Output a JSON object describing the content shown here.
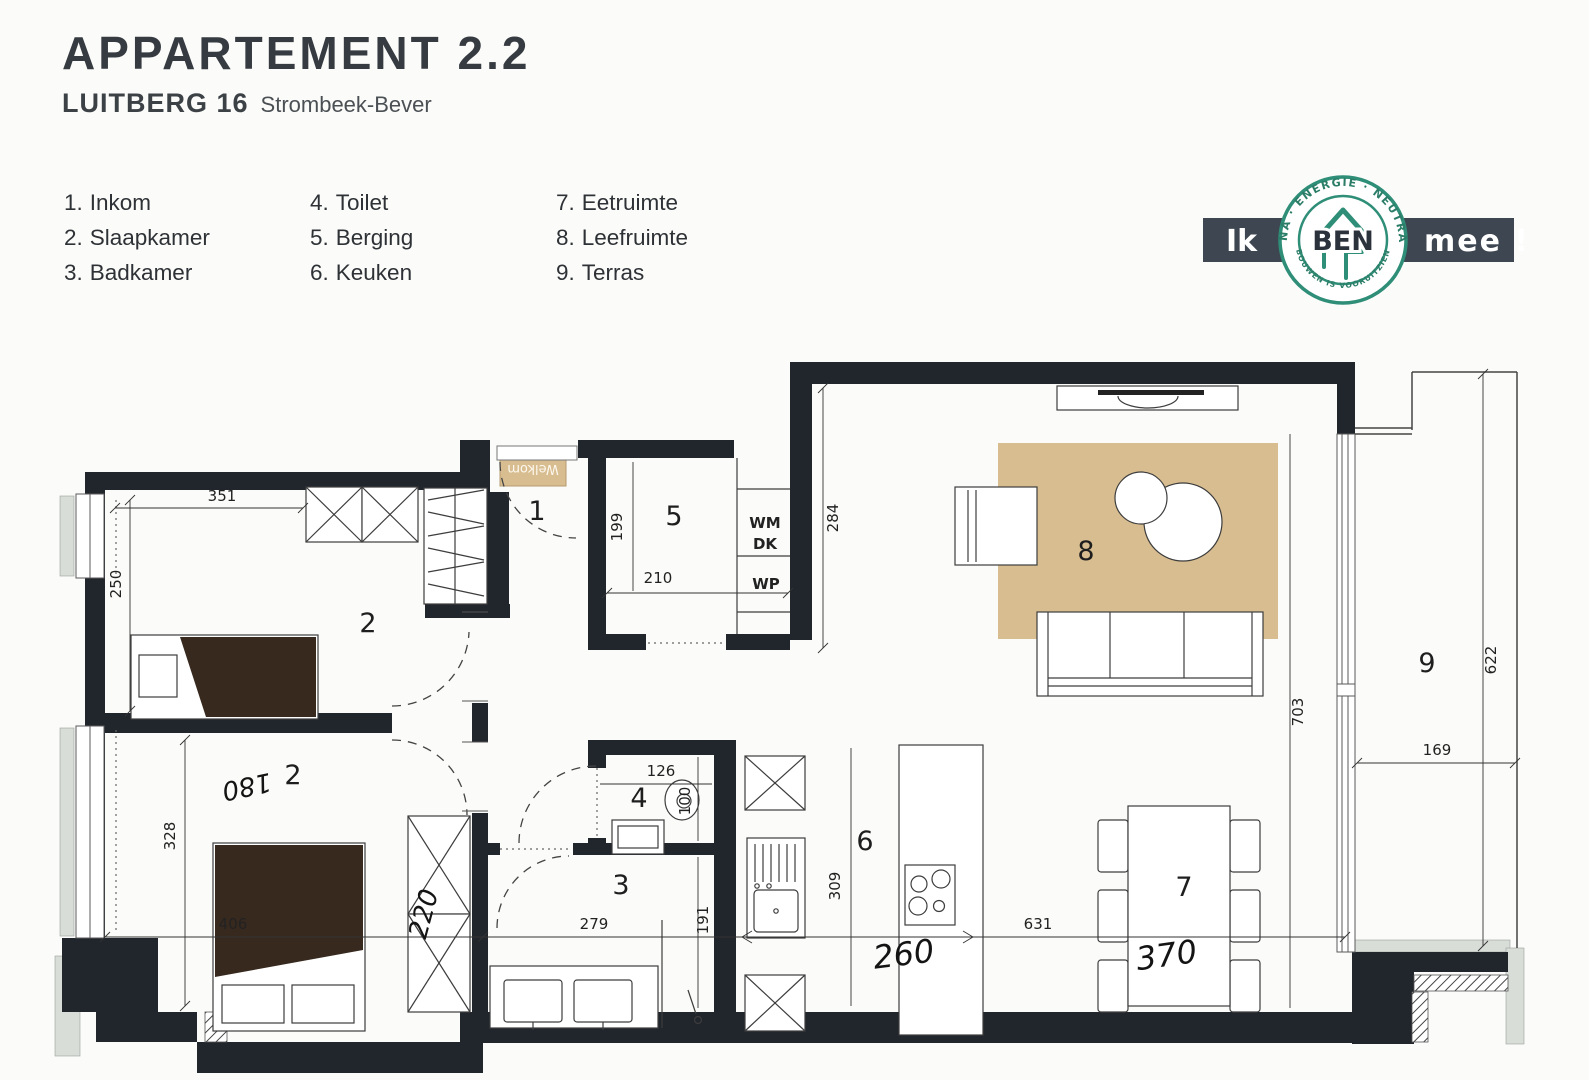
{
  "header": {
    "title": "APPARTEMENT 2.2",
    "project": "LUITBERG 16",
    "city": "Strombeek-Bever"
  },
  "legend": {
    "items": [
      {
        "num": "1.",
        "label": "Inkom"
      },
      {
        "num": "2.",
        "label": "Slaapkamer"
      },
      {
        "num": "3.",
        "label": "Badkamer"
      },
      {
        "num": "4.",
        "label": "Toilet"
      },
      {
        "num": "5.",
        "label": "Berging"
      },
      {
        "num": "6.",
        "label": "Keuken"
      },
      {
        "num": "7.",
        "label": "Eetruimte"
      },
      {
        "num": "8.",
        "label": "Leefruimte"
      },
      {
        "num": "9.",
        "label": "Terras"
      }
    ]
  },
  "logo": {
    "left": "Ik",
    "center": "BEN",
    "right": "mee !",
    "ring_top": "BIJNA · ENERGIE · NEUTRAAL",
    "ring_bottom": "BOUWEN IS VOORUITZIEN",
    "banner_color": "#3e4651",
    "ring_color": "#2f8e77"
  },
  "plan": {
    "rooms": {
      "r1": "1",
      "r2a": "2",
      "r2b": "2",
      "r3": "3",
      "r4": "4",
      "r5": "5",
      "r6": "6",
      "r7": "7",
      "r8": "8",
      "r9": "9"
    },
    "dims": {
      "d351": "351",
      "d250": "250",
      "d199": "199",
      "d210": "210",
      "d284": "284",
      "d703": "703",
      "d622": "622",
      "d169": "169",
      "d328": "328",
      "d406": "406",
      "d279": "279",
      "d191": "191",
      "d126": "126",
      "d100": "100",
      "d309": "309",
      "d631": "631"
    },
    "handwritten": {
      "h260": "260",
      "h370": "370",
      "h220": "220",
      "h180": "180"
    },
    "labels": {
      "wm": "WM",
      "dk": "DK",
      "wp": "WP",
      "welkom": "Welkom"
    },
    "colors": {
      "wall": "#21252c",
      "rug": "#d8bd90",
      "blanket": "#38291f"
    }
  }
}
